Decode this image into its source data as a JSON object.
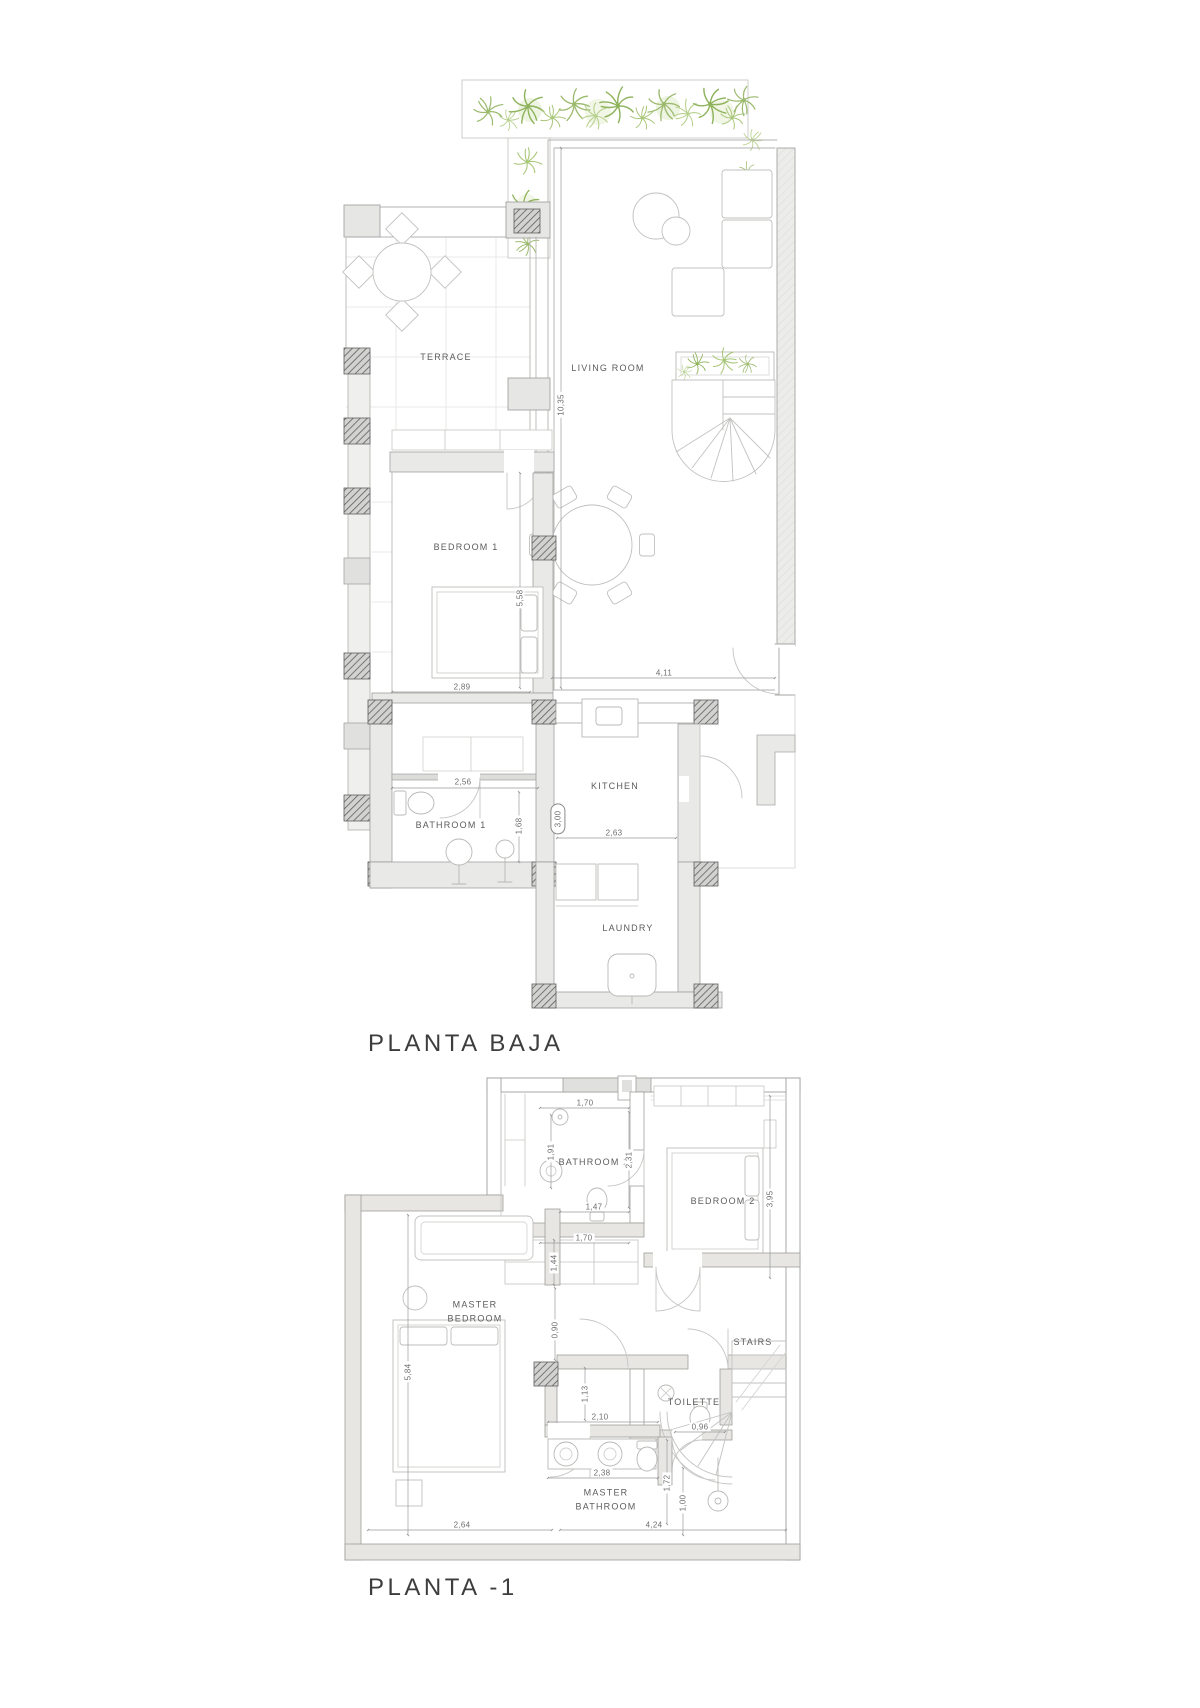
{
  "plans": [
    {
      "title": "PLANTA BAJA",
      "rooms": [
        {
          "label": "TERRACE",
          "x": 446,
          "y": 357
        },
        {
          "label": "LIVING ROOM",
          "x": 608,
          "y": 368
        },
        {
          "label": "BEDROOM 1",
          "x": 466,
          "y": 547
        },
        {
          "label": "BATHROOM 1",
          "x": 451,
          "y": 825
        },
        {
          "label": "KITCHEN",
          "x": 615,
          "y": 786
        },
        {
          "label": "LAUNDRY",
          "x": 628,
          "y": 928
        }
      ],
      "dimensions": [
        {
          "value": "10,35",
          "x": 561,
          "y": 405,
          "vertical": true
        },
        {
          "value": "5,58",
          "x": 520,
          "y": 598,
          "vertical": true
        },
        {
          "value": "2,89",
          "x": 462,
          "y": 687
        },
        {
          "value": "4,11",
          "x": 664,
          "y": 673
        },
        {
          "value": "2,56",
          "x": 463,
          "y": 782
        },
        {
          "value": "1,68",
          "x": 519,
          "y": 826,
          "vertical": true
        },
        {
          "value": "3,00",
          "x": 558,
          "y": 819,
          "vertical": true,
          "boxed": true
        },
        {
          "value": "2,63",
          "x": 614,
          "y": 833
        }
      ]
    },
    {
      "title": "PLANTA -1",
      "rooms": [
        {
          "label": "BATHROOM 2",
          "x": 594,
          "y": 1162
        },
        {
          "label": "BEDROOM 2",
          "x": 723,
          "y": 1201
        },
        {
          "label": "MASTER\nBEDROOM",
          "x": 475,
          "y": 1312
        },
        {
          "label": "STAIRS",
          "x": 753,
          "y": 1342
        },
        {
          "label": "TOILETTE",
          "x": 694,
          "y": 1402
        },
        {
          "label": "MASTER\nBATHROOM",
          "x": 606,
          "y": 1500
        }
      ],
      "dimensions": [
        {
          "value": "1,70",
          "x": 585,
          "y": 1103
        },
        {
          "value": "1,91",
          "x": 551,
          "y": 1152,
          "vertical": true
        },
        {
          "value": "2,31",
          "x": 629,
          "y": 1160,
          "vertical": true
        },
        {
          "value": "1,47",
          "x": 594,
          "y": 1207
        },
        {
          "value": "1,70",
          "x": 584,
          "y": 1238
        },
        {
          "value": "1,44",
          "x": 554,
          "y": 1263,
          "vertical": true
        },
        {
          "value": "3,95",
          "x": 770,
          "y": 1199,
          "vertical": true
        },
        {
          "value": "0,90",
          "x": 555,
          "y": 1330,
          "vertical": true
        },
        {
          "value": "5,84",
          "x": 408,
          "y": 1372,
          "vertical": true
        },
        {
          "value": "1,13",
          "x": 585,
          "y": 1394,
          "vertical": true
        },
        {
          "value": "2,10",
          "x": 600,
          "y": 1417
        },
        {
          "value": "0,96",
          "x": 700,
          "y": 1427
        },
        {
          "value": "2,38",
          "x": 602,
          "y": 1473
        },
        {
          "value": "1,72",
          "x": 667,
          "y": 1483,
          "vertical": true
        },
        {
          "value": "1,00",
          "x": 683,
          "y": 1503,
          "vertical": true
        },
        {
          "value": "2,64",
          "x": 462,
          "y": 1525
        },
        {
          "value": "4,24",
          "x": 654,
          "y": 1525
        }
      ]
    }
  ],
  "colors": {
    "plant_green": "#9cba6e",
    "plant_green_light": "#b8d18f",
    "wall_gray": "#e9e9e7",
    "hatch_dark": "#5f5f5f",
    "line_gray": "#9a9a9a",
    "label_text": "#5c5c5c",
    "title_text": "#3d3d3d"
  }
}
